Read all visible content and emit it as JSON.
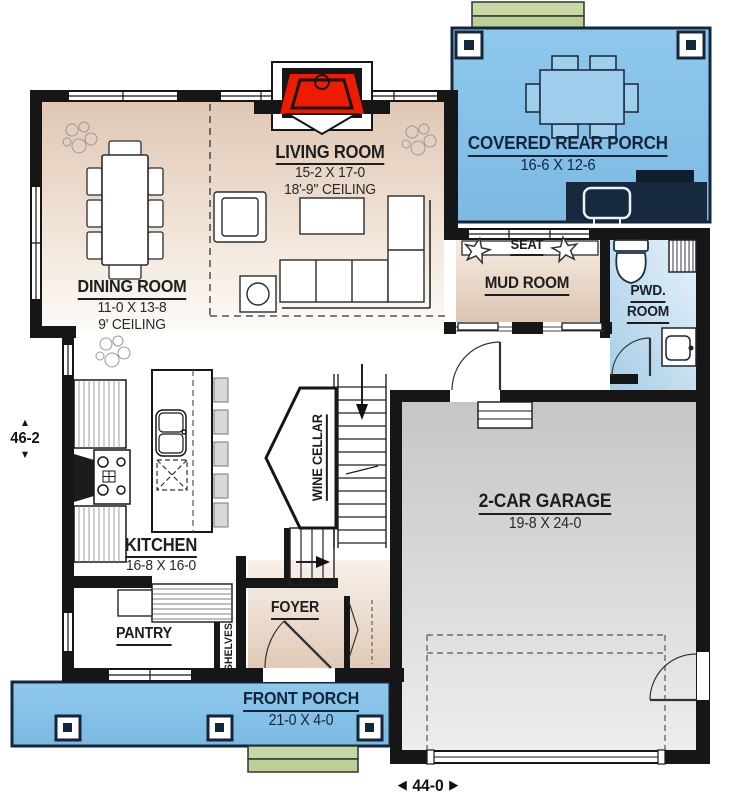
{
  "rooms": {
    "living_room": {
      "name": "LIVING ROOM",
      "dims": "15-2 X 17-0",
      "ceiling": "18'-9'' CEILING"
    },
    "dining_room": {
      "name": "DINING ROOM",
      "dims": "11-0 X 13-8",
      "ceiling": "9' CEILING"
    },
    "covered_rear_porch": {
      "name": "COVERED REAR PORCH",
      "dims": "16-6 X 12-6"
    },
    "mud_room": {
      "name": "MUD ROOM",
      "seat_label": "SEAT"
    },
    "pwd_room": {
      "name_line1": "PWD.",
      "name_line2": "ROOM"
    },
    "kitchen": {
      "name": "KITCHEN",
      "dims": "16-8 X 16-0"
    },
    "wine_cellar": {
      "name": "WINE CELLAR"
    },
    "garage": {
      "name": "2-CAR GARAGE",
      "dims": "19-8 X 24-0"
    },
    "foyer": {
      "name": "FOYER"
    },
    "pantry": {
      "name": "PANTRY",
      "shelves_label": "SHELVES"
    },
    "front_porch": {
      "name": "FRONT PORCH",
      "dims": "21-0 X 4-0"
    }
  },
  "overall_dimensions": {
    "depth": "46-2",
    "width": "44-0"
  },
  "icons": {
    "arrow_up": "▲",
    "arrow_down": "▼",
    "arrow_left": "◀",
    "arrow_right": "▶"
  },
  "colors": {
    "porch_blue": "#85c1e6",
    "porch_navy": "#14263c",
    "floor_beige": "#dfc7b4",
    "garage_gray": "#c9c9c9",
    "steps_green": "#c6d8a4",
    "fireplace_red": "#ee1b00",
    "wall_black": "#161616",
    "pwd_blue": "#bcd9ec"
  }
}
